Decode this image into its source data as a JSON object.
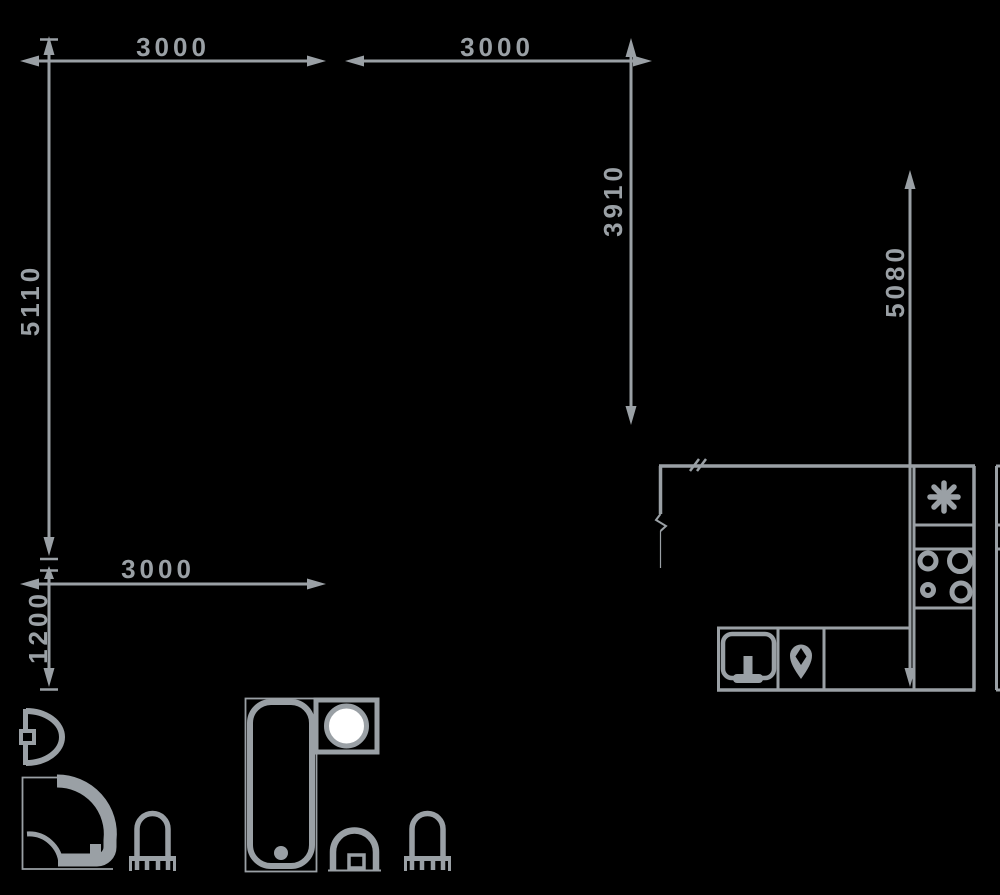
{
  "title": "apartment-floor-plan",
  "colors": {
    "background": "#000000",
    "line": "#9aa0a5",
    "washer_drum": "#ffffff"
  },
  "dimensions": {
    "top_left_width": "3000",
    "top_middle_width": "3000",
    "left_height": "5110",
    "middle_height": "3910",
    "right_height": "5080",
    "lower_width": "3000",
    "lower_height": "1200"
  },
  "fixtures": {
    "bathroom_small": [
      "wash-basin",
      "corner-shower",
      "toilet"
    ],
    "bathroom_large": [
      "bathtub",
      "washing-machine",
      "hand-basin",
      "toilet"
    ],
    "kitchen": [
      "fridge-snowflake",
      "cooktop-4-burners",
      "kitchen-sink",
      "water-drop-pin"
    ]
  }
}
